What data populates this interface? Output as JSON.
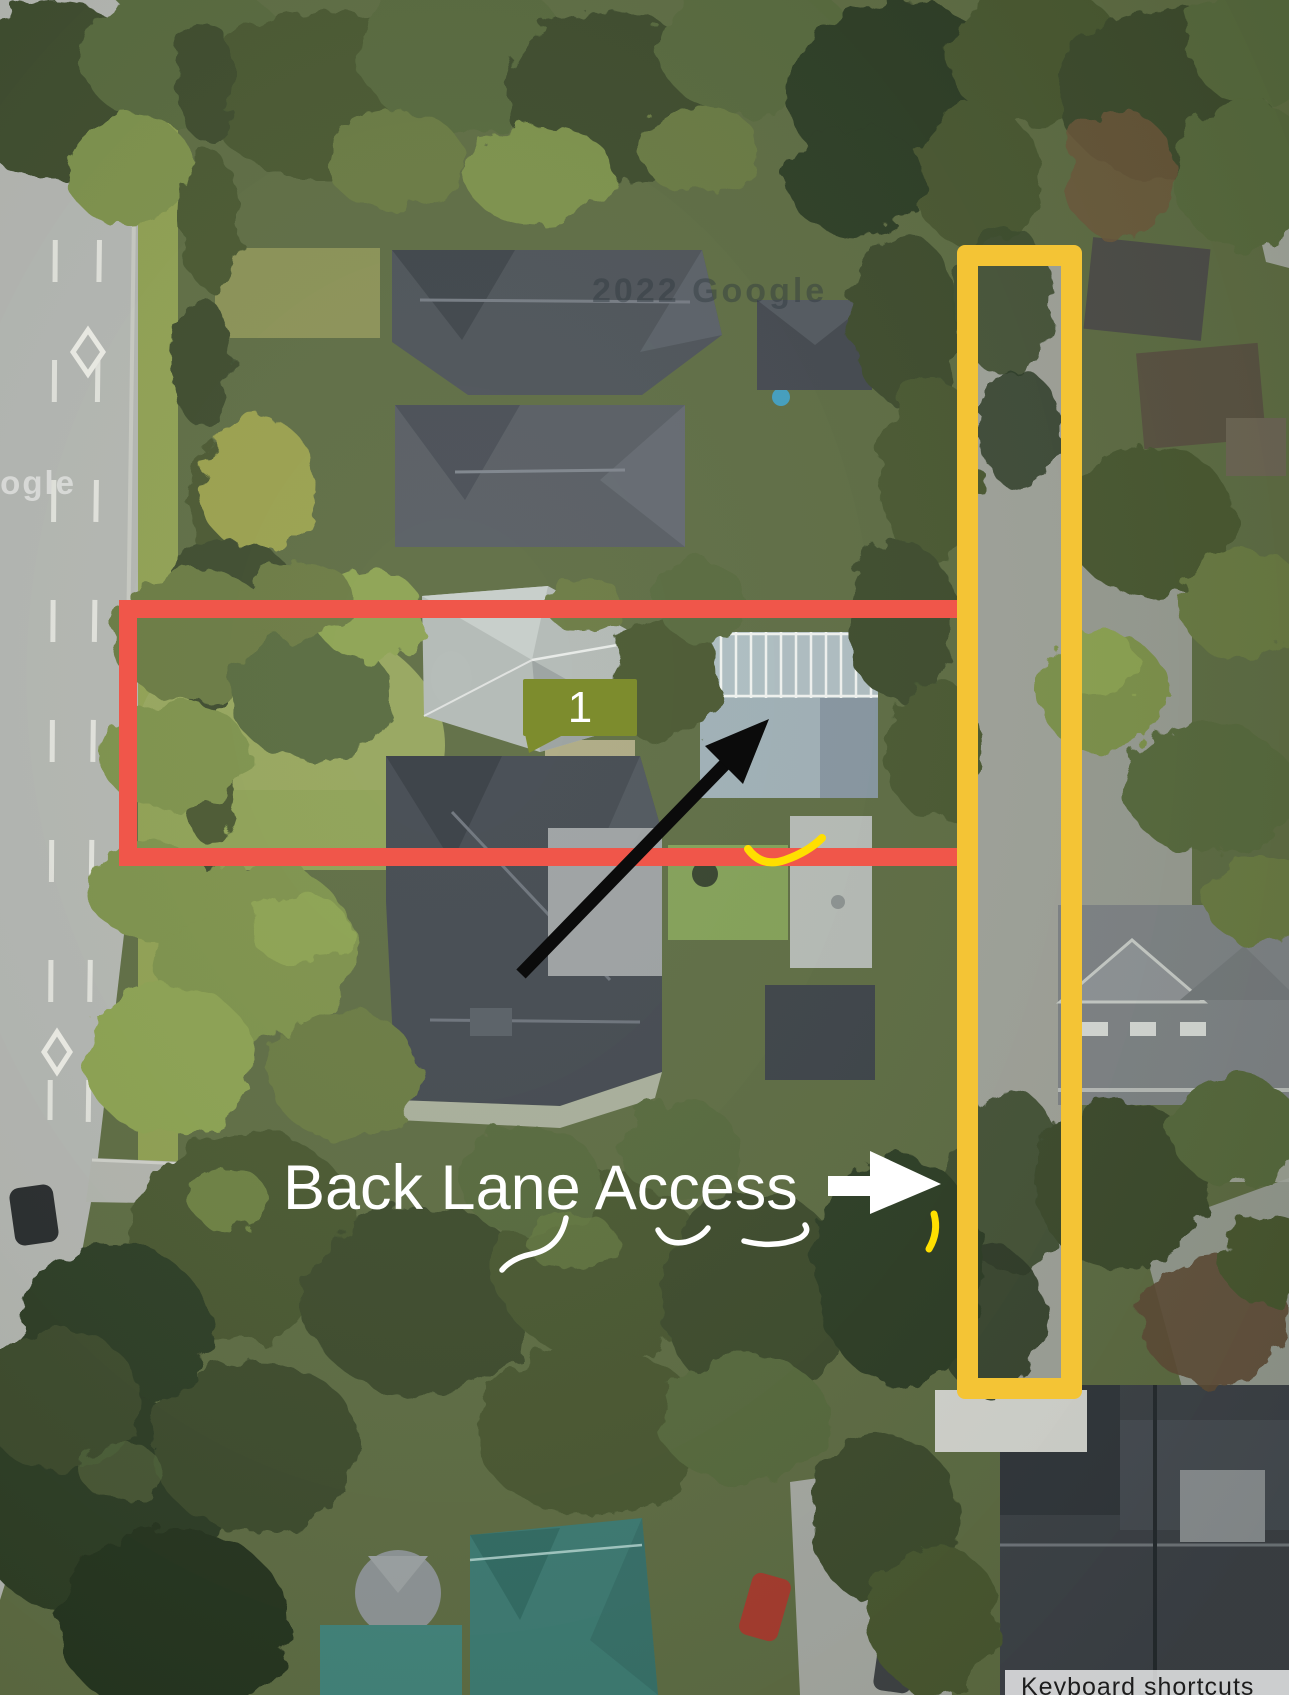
{
  "map": {
    "kind": "aerial-satellite-annotated",
    "scene": "residential block with tree canopy, arterial road on the left and rear lane on the right"
  },
  "annotations": {
    "parcel_marker": {
      "label": "1",
      "bg_color": "#7D8C2D",
      "text_color": "#FFFFFF"
    },
    "back_lane_label": {
      "text": "Back Lane Access",
      "color": "#FFFFFF"
    },
    "red_outline": {
      "color": "#F0564A"
    },
    "yellow_outline": {
      "color": "#F4C435"
    },
    "black_arrow": {
      "color": "#0B0B0B"
    },
    "white_arrow": {
      "color": "#FFFFFF"
    },
    "yellow_marks_color": "#FFDF00"
  },
  "watermarks": {
    "top": "2022 Google",
    "bottom_left": "oogle"
  },
  "footer": {
    "keyboard_shortcuts": "Keyboard shortcuts"
  }
}
